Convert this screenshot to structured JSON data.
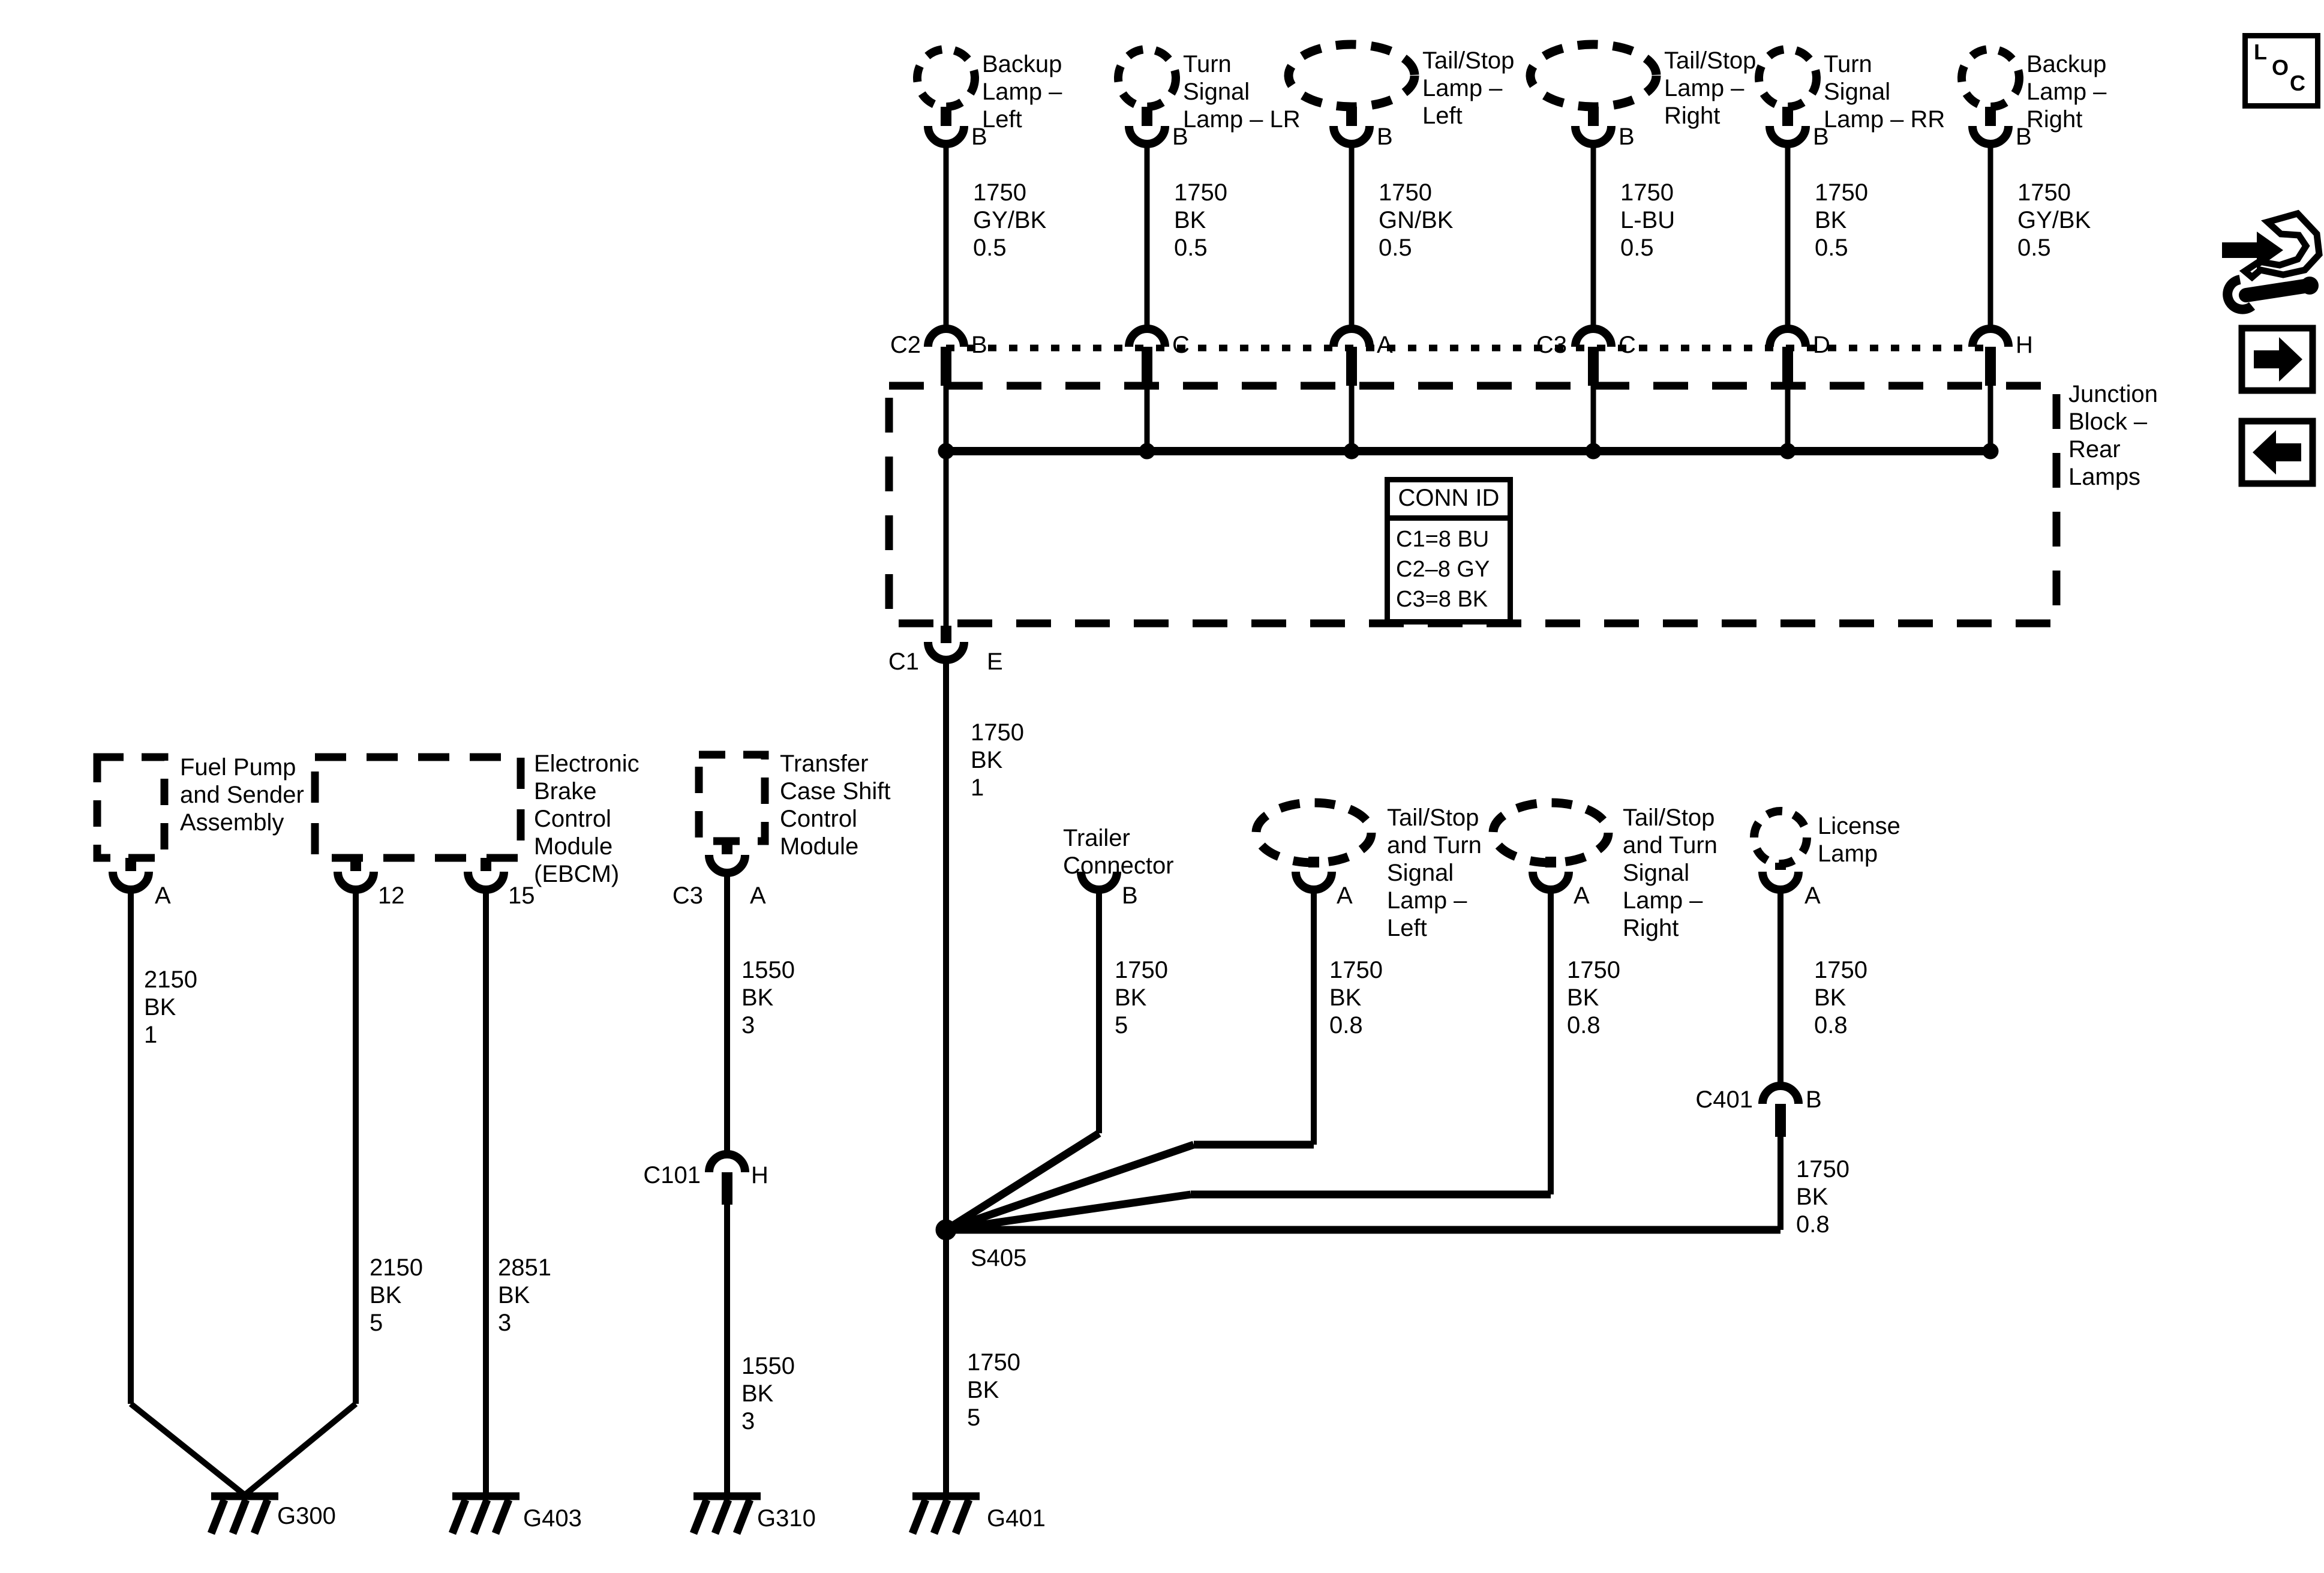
{
  "icons": {
    "loc_l": "L",
    "loc_o": "O",
    "loc_c": "C"
  },
  "junction": {
    "label": "Junction\nBlock –\nRear\nLamps",
    "c2": "C2",
    "c3": "C3",
    "pins": [
      "B",
      "C",
      "A",
      "C",
      "D",
      "H"
    ],
    "conn_id": {
      "header": "CONN ID",
      "row1": "C1=8 BU",
      "row2": "C2–8 GY",
      "row3": "C3=8 BK"
    }
  },
  "top_lamps": [
    {
      "name": "Backup\nLamp –\nLeft",
      "pin": "B",
      "wire": "1750\nGY/BK\n0.5"
    },
    {
      "name": "Turn\nSignal\nLamp – LR",
      "pin": "B",
      "wire": "1750\nBK\n0.5"
    },
    {
      "name": "Tail/Stop\nLamp –\nLeft",
      "pin": "B",
      "wire": "1750\nGN/BK\n0.5"
    },
    {
      "name": "Tail/Stop\nLamp –\nRight",
      "pin": "B",
      "wire": "1750\nL-BU\n0.5"
    },
    {
      "name": "Turn\nSignal\nLamp – RR",
      "pin": "B",
      "wire": "1750\nBK\n0.5"
    },
    {
      "name": "Backup\nLamp –\nRight",
      "pin": "B",
      "wire": "1750\nGY/BK\n0.5"
    }
  ],
  "c1": {
    "conn": "C1",
    "pin": "E",
    "wire": "1750\nBK\n1"
  },
  "splice": {
    "label": "S405"
  },
  "main": {
    "wire_lower": "1750\nBK\n5"
  },
  "fuel_pump": {
    "name": "Fuel Pump\nand Sender\nAssembly",
    "pin": "A",
    "wire": "2150\nBK\n1"
  },
  "ebcm": {
    "name": "Electronic\nBrake\nControl\nModule\n(EBCM)",
    "pin_12": "12",
    "pin_15": "15",
    "wire_12": "2150\nBK\n5",
    "wire_15": "2851\nBK\n3"
  },
  "transfer_case": {
    "name": "Transfer\nCase Shift\nControl\nModule",
    "conn": "C3",
    "pin": "A",
    "wire_upper": "1550\nBK\n3",
    "inline": {
      "conn": "C101",
      "pin": "H"
    },
    "wire_lower": "1550\nBK\n3"
  },
  "trailer": {
    "name": "Trailer\nConnector",
    "pin": "B",
    "wire": "1750\nBK\n5"
  },
  "tail_stop_left": {
    "name": "Tail/Stop\nand Turn\nSignal\nLamp –\nLeft",
    "pin": "A",
    "wire": "1750\nBK\n0.8"
  },
  "tail_stop_right": {
    "name": "Tail/Stop\nand Turn\nSignal\nLamp –\nRight",
    "pin": "A",
    "wire": "1750\nBK\n0.8"
  },
  "license": {
    "name": "License\nLamp",
    "pin": "A",
    "inline": {
      "conn": "C401",
      "pin": "B"
    },
    "wire_upper": "1750\nBK\n0.8",
    "wire_lower": "1750\nBK\n0.8"
  },
  "grounds": {
    "g300": "G300",
    "g403": "G403",
    "g310": "G310",
    "g401": "G401"
  }
}
